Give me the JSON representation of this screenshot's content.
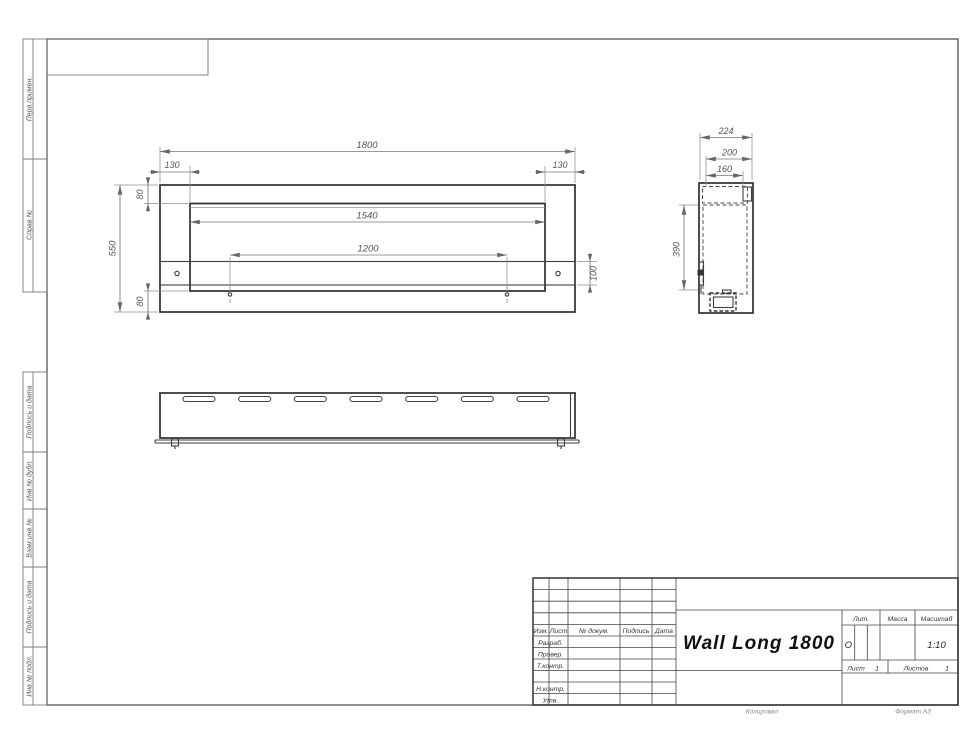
{
  "margin_labels": {
    "perv": "Перв.примен.",
    "sprav": "Справ.№",
    "podpis1": "Подпись и дата",
    "inv_dubl": "Инв.№ дубл.",
    "vzam_inv": "Взам.инв.№",
    "podpis2": "Подпись и дата",
    "inv_podl": "Инв.№ подл."
  },
  "front_view": {
    "total_width": "1800",
    "left_offset": "130",
    "right_offset": "130",
    "top_offset": "80",
    "inner_width": "1540",
    "total_height": "550",
    "mount_span": "1200",
    "rail_height": "100",
    "bottom_offset": "80"
  },
  "side_view": {
    "depth": "224",
    "inner_depth": "200",
    "top_opening": "160",
    "opening_height": "390"
  },
  "title_block": {
    "rev_cols": {
      "izm": "Изм.",
      "list": "Лист",
      "doc": "№ докум.",
      "sign": "Подпись",
      "date": "Дата"
    },
    "roles": {
      "razrab": "Разраб.",
      "prover": "Провер.",
      "tkontr": "Т.контр.",
      "nkontr": "Н.контр.",
      "utv": "Утв."
    },
    "title": "Wall Long 1800",
    "lit_label": "Лит.",
    "mass_label": "Масса",
    "scale_label": "Масштаб",
    "lit_value": "О",
    "scale_value": "1:10",
    "sheet_label": "Лист",
    "sheet_value": "1",
    "sheets_label": "Листов",
    "sheets_value": "1"
  },
  "footer": {
    "copied": "Копировал",
    "format": "Формат А3"
  }
}
